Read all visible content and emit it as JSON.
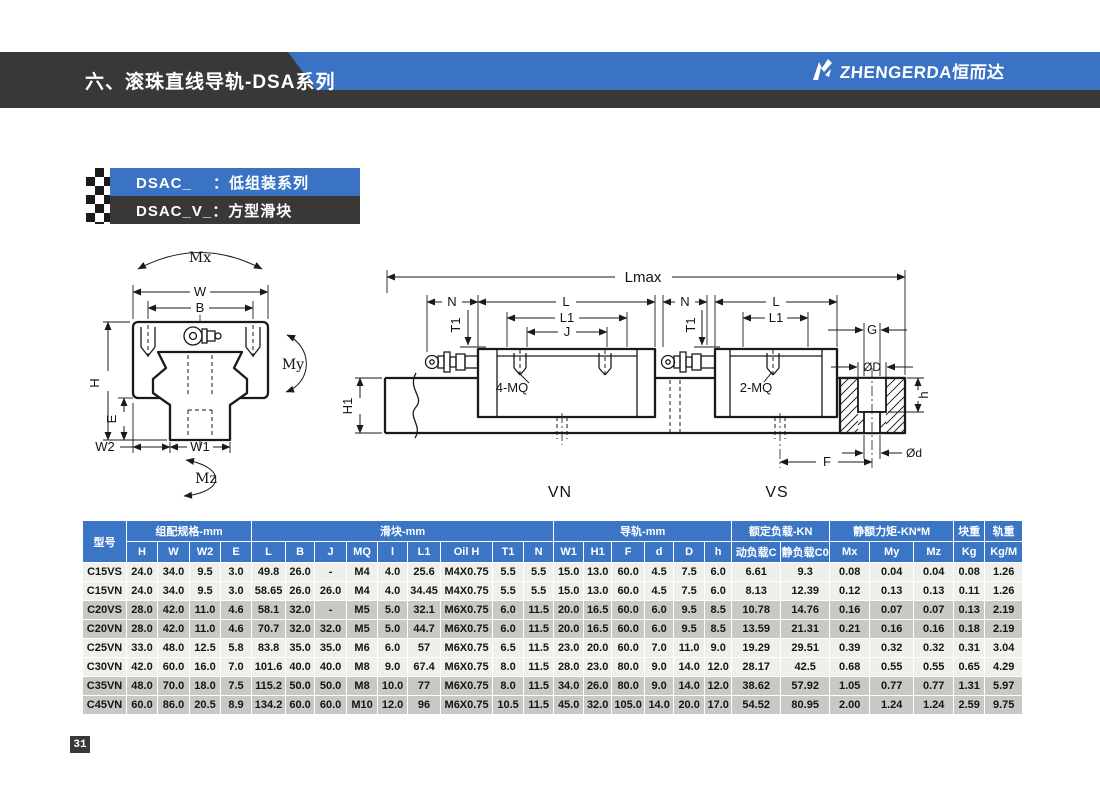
{
  "header": {
    "title": "六、滚珠直线导轨-DSA系列",
    "logo_text": "ZHENGERDA恒而达"
  },
  "series_labels": {
    "row1": "DSAC_　  ：低组装系列",
    "row2": "DSAC_V_：方型滑块"
  },
  "diagram": {
    "labels": {
      "mx": "Mx",
      "my": "My",
      "mz": "Mz",
      "w": "W",
      "b": "B",
      "h": "H",
      "e": "E",
      "w2": "W2",
      "w1": "W1",
      "lmax": "Lmax",
      "n": "N",
      "l": "L",
      "l1": "L1",
      "j": "J",
      "t1": "T1",
      "h1": "H1",
      "mq4": "4-MQ",
      "mq2": "2-MQ",
      "g": "G",
      "d_big": "ØD",
      "h_small": "h",
      "d_small": "Ød",
      "f": "F",
      "vn": "VN",
      "vs": "VS"
    }
  },
  "table": {
    "group_headers": [
      {
        "label": "型号",
        "colspan": 1,
        "rowspan": 2
      },
      {
        "label": "组配规格-mm",
        "colspan": 4,
        "rowspan": 1
      },
      {
        "label": "滑块-mm",
        "colspan": 9,
        "rowspan": 1
      },
      {
        "label": "导轨-mm",
        "colspan": 6,
        "rowspan": 1
      },
      {
        "label": "额定负载-KN",
        "colspan": 2,
        "rowspan": 1
      },
      {
        "label": "静额力矩-KN*M",
        "colspan": 3,
        "rowspan": 1
      },
      {
        "label": "块重",
        "colspan": 1,
        "rowspan": 1
      },
      {
        "label": "轨重",
        "colspan": 1,
        "rowspan": 1
      }
    ],
    "columns": [
      "H",
      "W",
      "W2",
      "E",
      "L",
      "B",
      "J",
      "MQ",
      "l",
      "L1",
      "Oil H",
      "T1",
      "N",
      "W1",
      "H1",
      "F",
      "d",
      "D",
      "h",
      "动负载C",
      "静负载C0",
      "Mx",
      "My",
      "Mz",
      "Kg",
      "Kg/M"
    ],
    "col_widths": [
      44,
      31,
      32,
      31,
      31,
      34,
      29,
      32,
      31,
      30,
      33,
      52,
      31,
      30,
      30,
      28,
      33,
      29,
      31,
      27,
      49,
      49,
      40,
      44,
      40,
      31,
      38
    ],
    "rows": [
      {
        "model": "C15VS",
        "values": [
          "24.0",
          "34.0",
          "9.5",
          "3.0",
          "49.8",
          "26.0",
          "-",
          "M4",
          "4.0",
          "25.6",
          "M4X0.75",
          "5.5",
          "5.5",
          "15.0",
          "13.0",
          "60.0",
          "4.5",
          "7.5",
          "6.0",
          "6.61",
          "9.3",
          "0.08",
          "0.04",
          "0.04",
          "0.08",
          "1.26"
        ]
      },
      {
        "model": "C15VN",
        "values": [
          "24.0",
          "34.0",
          "9.5",
          "3.0",
          "58.65",
          "26.0",
          "26.0",
          "M4",
          "4.0",
          "34.45",
          "M4X0.75",
          "5.5",
          "5.5",
          "15.0",
          "13.0",
          "60.0",
          "4.5",
          "7.5",
          "6.0",
          "8.13",
          "12.39",
          "0.12",
          "0.13",
          "0.13",
          "0.11",
          "1.26"
        ]
      },
      {
        "model": "C20VS",
        "values": [
          "28.0",
          "42.0",
          "11.0",
          "4.6",
          "58.1",
          "32.0",
          "-",
          "M5",
          "5.0",
          "32.1",
          "M6X0.75",
          "6.0",
          "11.5",
          "20.0",
          "16.5",
          "60.0",
          "6.0",
          "9.5",
          "8.5",
          "10.78",
          "14.76",
          "0.16",
          "0.07",
          "0.07",
          "0.13",
          "2.19"
        ]
      },
      {
        "model": "C20VN",
        "values": [
          "28.0",
          "42.0",
          "11.0",
          "4.6",
          "70.7",
          "32.0",
          "32.0",
          "M5",
          "5.0",
          "44.7",
          "M6X0.75",
          "6.0",
          "11.5",
          "20.0",
          "16.5",
          "60.0",
          "6.0",
          "9.5",
          "8.5",
          "13.59",
          "21.31",
          "0.21",
          "0.16",
          "0.16",
          "0.18",
          "2.19"
        ]
      },
      {
        "model": "C25VN",
        "values": [
          "33.0",
          "48.0",
          "12.5",
          "5.8",
          "83.8",
          "35.0",
          "35.0",
          "M6",
          "6.0",
          "57",
          "M6X0.75",
          "6.5",
          "11.5",
          "23.0",
          "20.0",
          "60.0",
          "7.0",
          "11.0",
          "9.0",
          "19.29",
          "29.51",
          "0.39",
          "0.32",
          "0.32",
          "0.31",
          "3.04"
        ]
      },
      {
        "model": "C30VN",
        "values": [
          "42.0",
          "60.0",
          "16.0",
          "7.0",
          "101.6",
          "40.0",
          "40.0",
          "M8",
          "9.0",
          "67.4",
          "M6X0.75",
          "8.0",
          "11.5",
          "28.0",
          "23.0",
          "80.0",
          "9.0",
          "14.0",
          "12.0",
          "28.17",
          "42.5",
          "0.68",
          "0.55",
          "0.55",
          "0.65",
          "4.29"
        ]
      },
      {
        "model": "C35VN",
        "values": [
          "48.0",
          "70.0",
          "18.0",
          "7.5",
          "115.2",
          "50.0",
          "50.0",
          "M8",
          "10.0",
          "77",
          "M6X0.75",
          "8.0",
          "11.5",
          "34.0",
          "26.0",
          "80.0",
          "9.0",
          "14.0",
          "12.0",
          "38.62",
          "57.92",
          "1.05",
          "0.77",
          "0.77",
          "1.31",
          "5.97"
        ]
      },
      {
        "model": "C45VN",
        "values": [
          "60.0",
          "86.0",
          "20.5",
          "8.9",
          "134.2",
          "60.0",
          "60.0",
          "M10",
          "12.0",
          "96",
          "M6X0.75",
          "10.5",
          "11.5",
          "45.0",
          "32.0",
          "105.0",
          "14.0",
          "20.0",
          "17.0",
          "54.52",
          "80.95",
          "2.00",
          "1.24",
          "1.24",
          "2.59",
          "9.75"
        ]
      }
    ]
  },
  "footer": {
    "page_number": "31"
  }
}
